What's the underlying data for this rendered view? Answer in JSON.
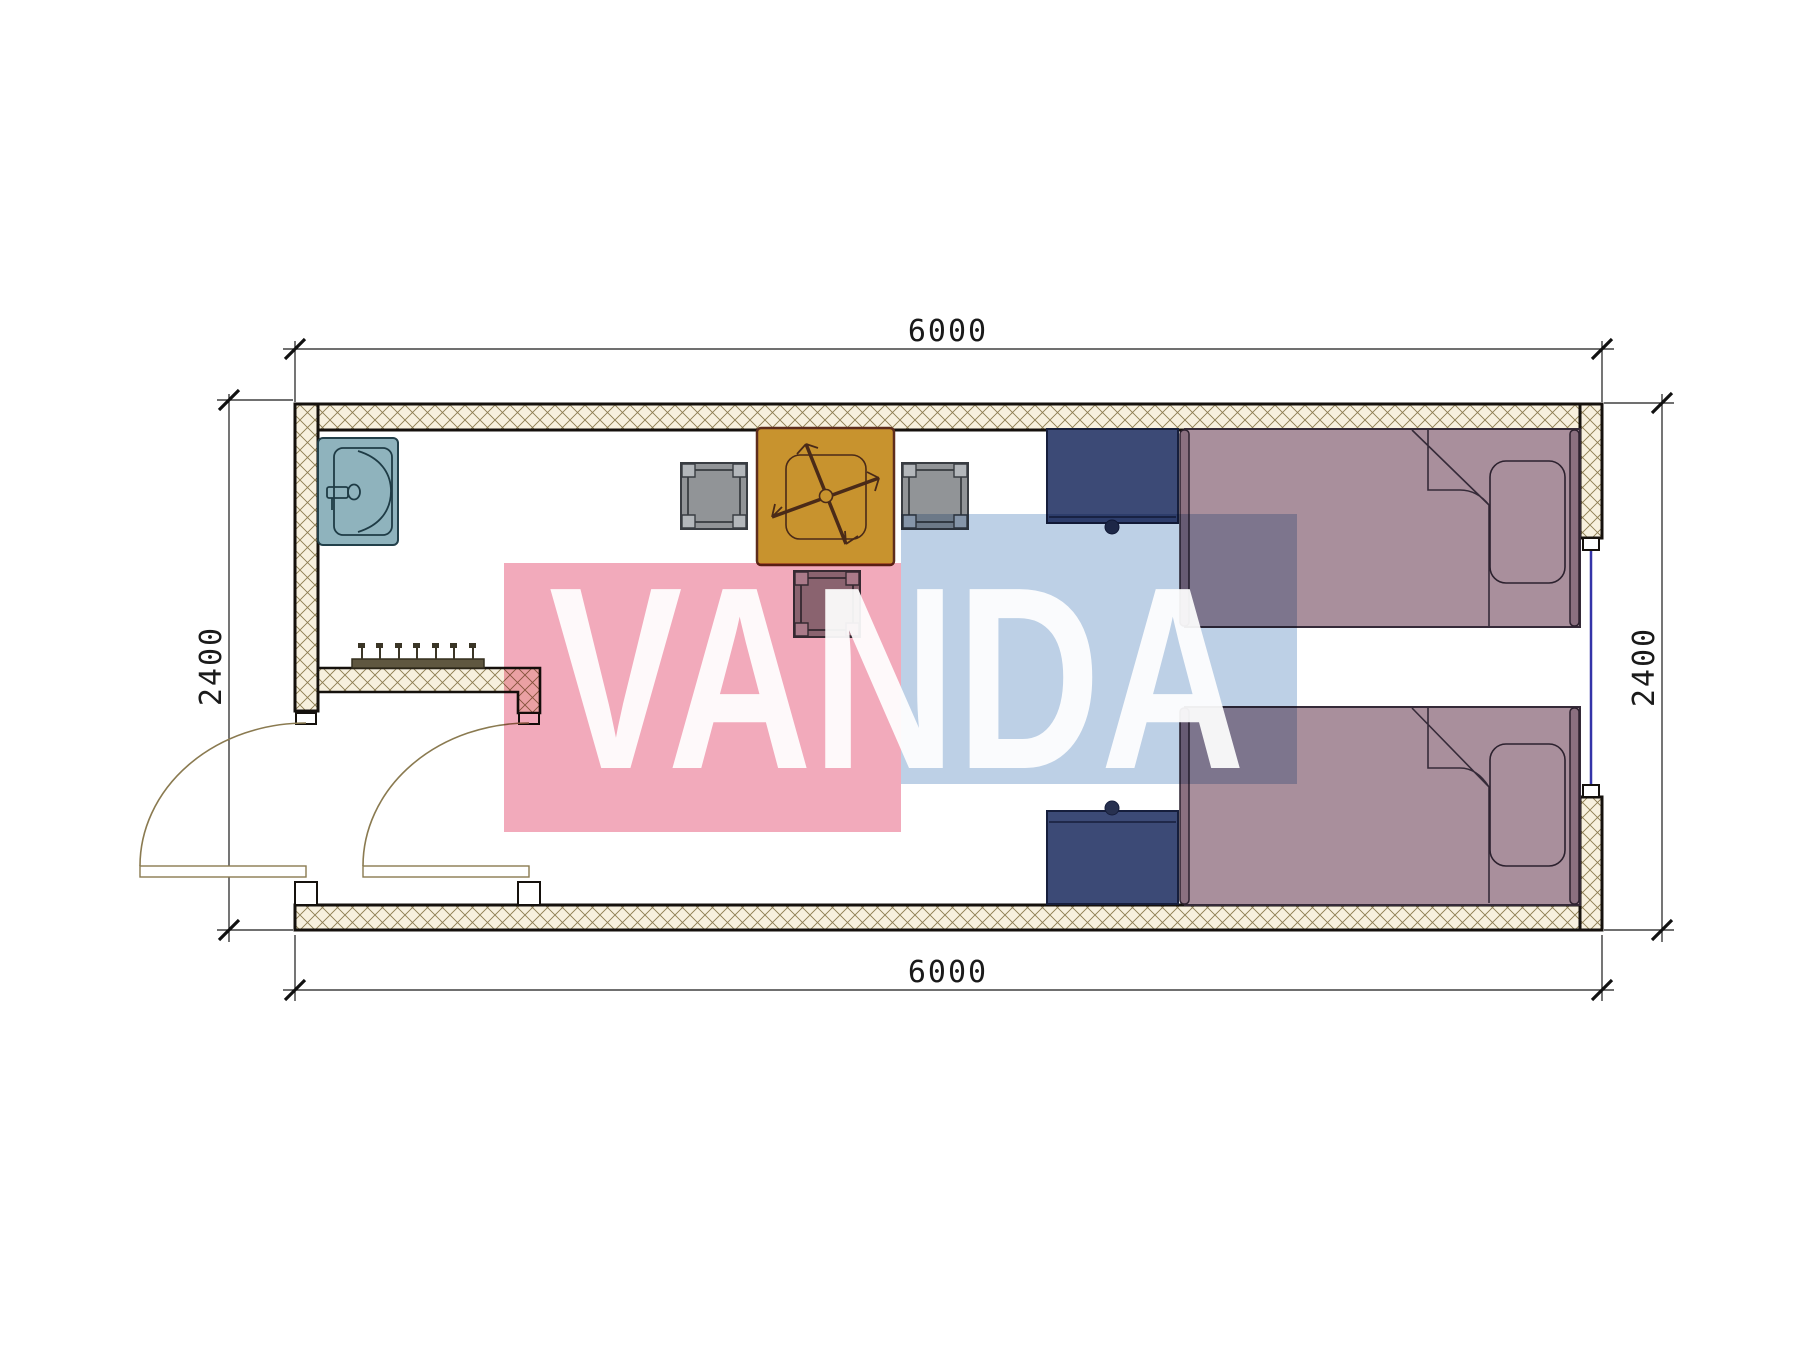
{
  "drawing": {
    "type": "floor-plan",
    "room_width_mm": "6000",
    "room_depth_mm": "2400"
  },
  "dimensions": {
    "top": "6000",
    "bottom": "6000",
    "left": "2400",
    "right": "2400"
  },
  "watermark": {
    "text": "VANDA",
    "pink_color": "#f2aabb",
    "blue_color": "#bdd0e6",
    "text_color": "#ffffff"
  },
  "colors": {
    "wall_outline": "#15110d",
    "hatch_bg": "#f7f0de",
    "hatch_line": "#8c7c50",
    "sink_fill": "#8fb3bd",
    "table_fill": "#c8932e",
    "stool_fill": "#919497",
    "nightstand_fill": "#3c4a76",
    "bed_fill": "#a98f9c",
    "door_arc_color": "#8a7a50",
    "window_color": "#3434a8",
    "dimension_color": "#1a1a1a"
  }
}
